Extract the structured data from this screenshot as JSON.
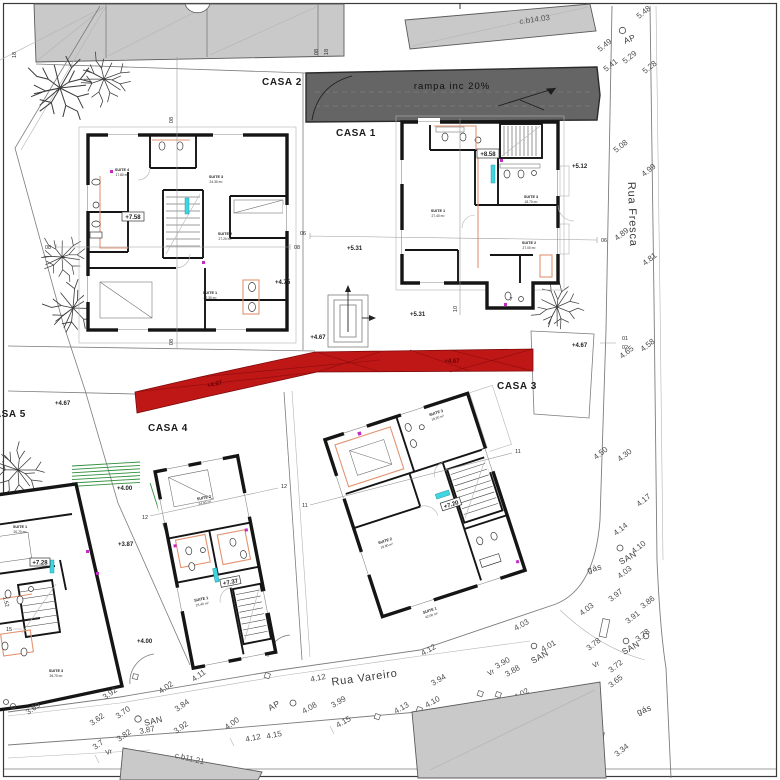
{
  "drawing": {
    "houses": {
      "casa1": {
        "label": "CASA 1",
        "floor_level": "+8.58",
        "suites": [
          {
            "name": "SUITE 1",
            "area": "27.40 m²"
          },
          {
            "name": "SUITE 2",
            "area": "27.00 m²"
          },
          {
            "name": "SUITE 3",
            "area": "18.70 m²"
          }
        ]
      },
      "casa2": {
        "label": "CASA 2",
        "floor_level": "+7.58",
        "suites": [
          {
            "name": "SUITE 4",
            "area": "17.80 m²"
          },
          {
            "name": "SUITE 3",
            "area": "24.30 m²"
          },
          {
            "name": "SUITE 2",
            "area": "27.20 m²"
          },
          {
            "name": "SUITE 1",
            "area": "42.30 m²"
          }
        ]
      },
      "casa3": {
        "label": "CASA 3",
        "floor_level": "+7.20",
        "suites": [
          {
            "name": "SUITE 3",
            "area": "18.20 m²"
          },
          {
            "name": "SUITE 2",
            "area": "19.80 m²"
          },
          {
            "name": "SUITE 1",
            "area": "42.00 m²"
          }
        ]
      },
      "casa4": {
        "label": "CASA 4",
        "floor_level": "+7.37",
        "suites": [
          {
            "name": "SUITE 2",
            "area": "24.90 m²"
          },
          {
            "name": "SUITE 1",
            "area": "23.40 m²"
          }
        ]
      },
      "casa5": {
        "label": "CASA 5",
        "floor_level": "+7.28",
        "suites": [
          {
            "name": "SUITE 1",
            "area": "20.70 m²"
          },
          {
            "name": "SUITE 3",
            "area": "26.70 m²"
          }
        ]
      }
    },
    "streets": {
      "fresca": "Rua Fresca",
      "vareiro": "Rua Vareiro"
    },
    "ramp": {
      "label": "rampa   inc 20%"
    },
    "neighbors": {
      "top": "c.b14.03",
      "bottom": "c.b11.21"
    },
    "utilities": {
      "ap": "AP",
      "san": "SAN",
      "gas": "gás",
      "vr": "Vr"
    },
    "site_levels": [
      "+4.75",
      "+5.31",
      "+5.31",
      "+5.12",
      "+4.67",
      "+4.67",
      "+4.67",
      "+4.67",
      "+4.67",
      "+4.00",
      "+3.87",
      "+4.00"
    ],
    "grid": {
      "g01": "01",
      "g02": "02",
      "g06": "06",
      "g07": "7",
      "g08": "08",
      "g10": "10",
      "g11": "11",
      "g12": "12",
      "g15": "15",
      "g18": "18"
    },
    "misc": {
      "dim_152": "1.52"
    },
    "spot_elevations": {
      "fresca": [
        "5.48",
        "5.49",
        "5.29",
        "5.41",
        "5.28",
        "5.08",
        "4.99",
        "4.89",
        "4.81",
        "4.65",
        "4.58",
        "4.50",
        "4.30",
        "4.17",
        "4.14",
        "4.10",
        "4.03",
        "3.97",
        "3.86",
        "4.03",
        "3.91",
        "3.78",
        "3.65",
        "3.34",
        "3.78",
        "3.72"
      ],
      "vareiro": [
        "3.69",
        "3.62",
        "3.92",
        "3.70",
        "3.87",
        "3.82",
        "3.7",
        "4.02",
        "3.84",
        "3.92",
        "4.11",
        "4.00",
        "4.12",
        "4.15",
        "4.02",
        "4.12",
        "4.08",
        "3.99",
        "4.12",
        "3.94",
        "4.15",
        "4.13",
        "4.10",
        "4.03",
        "4.01",
        "3.90",
        "3.88"
      ]
    }
  }
}
